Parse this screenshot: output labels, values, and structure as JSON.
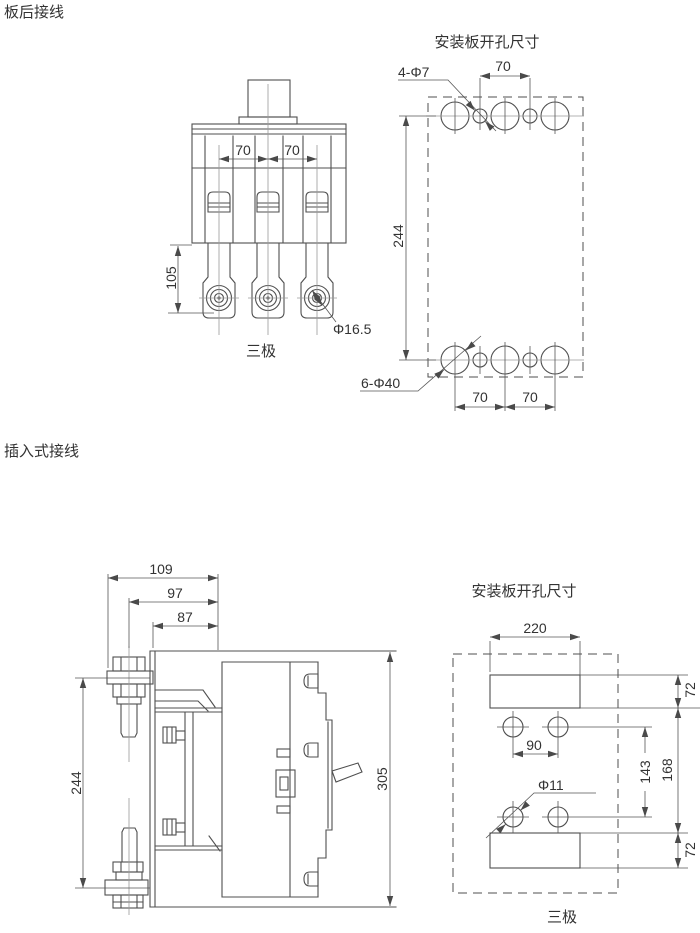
{
  "labels": {
    "rear_wiring": "板后接线",
    "plugin_wiring": "插入式接线"
  },
  "front_view": {
    "pole_label": "三极",
    "dim_70_left": "70",
    "dim_70_right": "70",
    "dim_105": "105",
    "dim_hole": "Φ16.5"
  },
  "plate_top": {
    "title": "安装板开孔尺寸",
    "dim_small_holes": "4-Φ7",
    "dim_70_top": "70",
    "dim_244": "244",
    "dim_large_holes": "6-Φ40",
    "dim_70_bottom_left": "70",
    "dim_70_bottom_right": "70"
  },
  "side_view": {
    "dim_109": "109",
    "dim_97": "97",
    "dim_87": "87",
    "dim_244": "244",
    "dim_305": "305"
  },
  "plate_bottom": {
    "title": "安装板开孔尺寸",
    "pole_label": "三极",
    "dim_220": "220",
    "dim_72_top": "72",
    "dim_90": "90",
    "dim_phi11": "Φ11",
    "dim_143": "143",
    "dim_168": "168",
    "dim_72_bottom": "72"
  }
}
